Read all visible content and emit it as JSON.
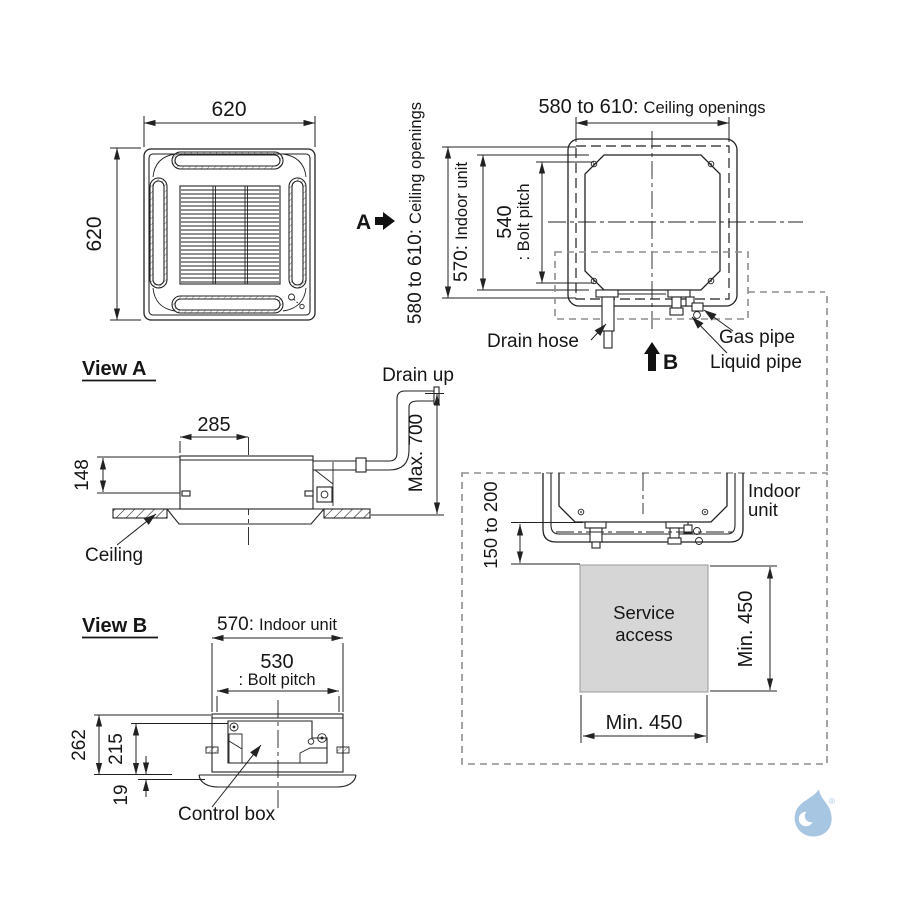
{
  "colors": {
    "line": "#222222",
    "dashed_boundary": "#8d8d8d",
    "service_area_fill": "#d6d6d6",
    "logo_blue": "#a7c6e2",
    "text": "#161616"
  },
  "top_left_view": {
    "width_dim": "620",
    "height_dim": "620",
    "view_arrow_label": "A"
  },
  "top_right_view": {
    "ceiling_openings_title_num": "580 to 610:",
    "ceiling_openings_title_text": "Ceiling openings",
    "side_ceiling_openings_num": "580 to 610:",
    "side_ceiling_openings_text": "Ceiling openings",
    "indoor_unit_dim_num": "570:",
    "indoor_unit_dim_text": "Indoor unit",
    "bolt_pitch_num": "540",
    "bolt_pitch_text": ": Bolt pitch",
    "drain_hose_label": "Drain hose",
    "gas_pipe_label": "Gas pipe",
    "liquid_pipe_label": "Liquid pipe",
    "view_arrow_label": "B"
  },
  "view_a": {
    "heading": "View A",
    "drain_up_label": "Drain up",
    "width_dim": "285",
    "height_dim": "148",
    "drain_height_dim": "Max. 700",
    "ceiling_label": "Ceiling"
  },
  "view_b": {
    "heading": "View B",
    "indoor_unit_dim_num": "570:",
    "indoor_unit_dim_text": "Indoor unit",
    "bolt_pitch_num": "530",
    "bolt_pitch_text": ": Bolt pitch",
    "total_height_dim": "262",
    "body_height_dim": "215",
    "panel_height_dim": "19",
    "control_box_label": "Control box"
  },
  "service_view": {
    "indoor_unit_label_line1": "Indoor",
    "indoor_unit_label_line2": "unit",
    "clearance_dim": "150 to 200",
    "service_access_line1": "Service",
    "service_access_line2": "access",
    "side_clearance_dim": "Min. 450",
    "bottom_clearance_dim": "Min. 450"
  },
  "logo": {
    "registered_mark": "®"
  }
}
